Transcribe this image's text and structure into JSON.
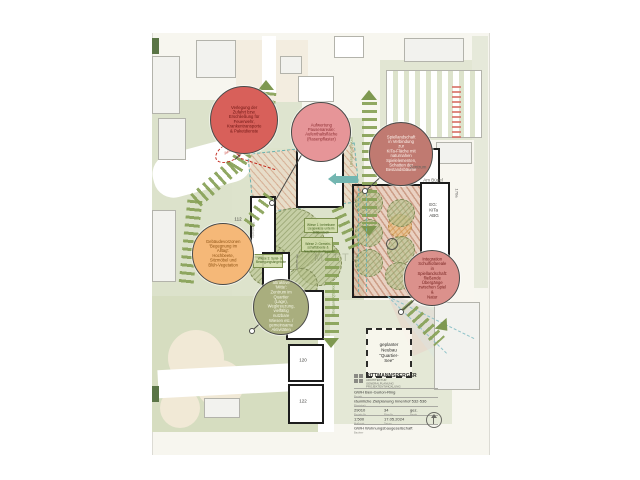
{
  "sheet": {
    "balloons": [
      {
        "text": "Verlegung der\nZufahrt bzw.\nErschließung für\nFeuerwehr,\nKrankentransporte\n& Paketdienste"
      },
      {
        "text": "Aufwertung\nPausenareale:\nAufenthaltsfläche\n(Rasenpflaster)"
      },
      {
        "text": "Spiellandschaft\nin Verbindung zur\nKiTa-Fläche mit\nnaturnahen\nSpielelementen,\nSchatten der\nBestandsbäume"
      },
      {
        "text": "Gebäudevorzonen\n'Begegnung im\nAlltag':\nHochbeete,\nSitzmöbel und\nBlüh-Vegetation"
      },
      {
        "text": "attraktive 'Mitte':\nZentrum im Quartier\n(Lage), Wegkreuzung,\nvielfältig nutzbare\nWiesen etc. /\ngemeinsame\nAktivitäten"
      },
      {
        "text": "Integration\nSchulhofareale in\nSpiellandschaft:\nfließende\nÜbergänge\nzwischen Spiel &\nNatur"
      }
    ],
    "building_numbers": {
      "b584": "584",
      "b50b": "50b",
      "b508": "508",
      "b110": "110",
      "b112": "112",
      "b114": "114",
      "b118": "118",
      "b120": "120",
      "b122": "122",
      "b10b": "10b",
      "b170a": "170a"
    },
    "area_labels": {
      "zentrum": "Zentrum",
      "am_buegel": "Am Bügel",
      "buergerhaus": "Bürgerhaus",
      "kita_floors": "EG:\nKiTa\nABG",
      "uebergang_ost": "Übergang QS-Ost",
      "uebergang_sued": "Übergang QS-Süd",
      "zufahrt": "Zufahrt",
      "mitte": "MITTE",
      "raumkante1": "Raumkante",
      "raumkante2": "Raumkante"
    },
    "green_notes": [
      "Wiese 1: betretbare\nLiegewiese unterm\nBlätterdach",
      "Wiese 2: Gemein-\nschaftsbeete &\nNachbarschaftsgärten",
      "Wiese 3: Spiel- &\nBewegungsangebote"
    ],
    "planned_building": "geplanter\nNeubau\n\"Quartier-See\""
  },
  "titleblock": {
    "firm": "RITTMANNSPERGER",
    "firm_sub": "ARCHITEKTUR\nGENERALPLANUNG\nPROJEKTENTWICKLUNG",
    "project": "GWH Ben-Gurion-Ring",
    "project_label": "Projekt",
    "plan_title": "räumliche Zielplanung Innenhof 532-536",
    "plan_label": "Planinhalt",
    "cells": [
      {
        "v": "29010",
        "l": "Projekt-Nr."
      },
      {
        "v": "34",
        "l": "Plan-Nr."
      },
      {
        "v": "gez.",
        "l": "Bearb."
      },
      {
        "v": "1:500",
        "l": "Maßstab"
      },
      {
        "v": "17.05.2024",
        "l": "Datum"
      }
    ],
    "client": "GWH Wohnungsbaugesellschaft",
    "client_label": "Bauherr"
  },
  "palette": {
    "path_green": "#87a156",
    "balloon_red": "#d8605a",
    "balloon_pink": "#e69598",
    "balloon_terracotta": "#c07a71",
    "balloon_orange": "#f5b878",
    "balloon_olive": "#a9ae7e",
    "balloon_rose": "#db918c",
    "teal": "#73b6b1",
    "alert_red": "#c2281c",
    "sage": "#dde3cc",
    "cream": "#f3ede0"
  }
}
